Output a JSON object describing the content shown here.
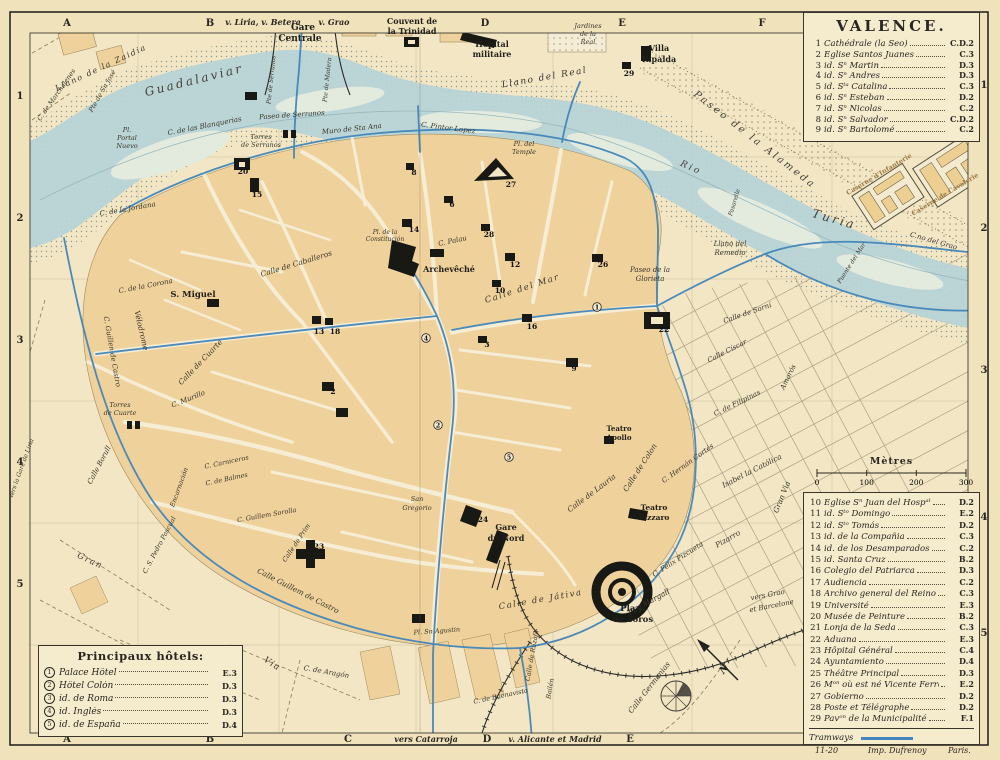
{
  "title": "VALENCE.",
  "colors": {
    "paper": "#f0e2bb",
    "block": "#efd19b",
    "water": "#b7d3d6",
    "tram": "#4286bb",
    "ink": "#2a2722",
    "legend_bg": "#f5ebcd"
  },
  "frame": {
    "top_letters": [
      {
        "t": "A",
        "x": 67
      },
      {
        "t": "B",
        "x": 210
      },
      {
        "t": "D",
        "x": 485
      },
      {
        "t": "E",
        "x": 622
      },
      {
        "t": "F",
        "x": 762
      }
    ],
    "bottom_letters": [
      {
        "t": "A",
        "x": 67
      },
      {
        "t": "B",
        "x": 210
      },
      {
        "t": "C",
        "x": 348
      },
      {
        "t": "D",
        "x": 487
      },
      {
        "t": "E",
        "x": 630
      }
    ],
    "left_numbers": [
      {
        "t": "1",
        "y": 96
      },
      {
        "t": "2",
        "y": 218
      },
      {
        "t": "3",
        "y": 340
      },
      {
        "t": "4",
        "y": 462
      },
      {
        "t": "5",
        "y": 584
      }
    ],
    "right_numbers": [
      {
        "t": "1",
        "y": 85
      },
      {
        "t": "2",
        "y": 228
      },
      {
        "t": "3",
        "y": 370
      },
      {
        "t": "4",
        "y": 517
      },
      {
        "t": "5",
        "y": 633
      }
    ],
    "top_routes": [
      {
        "t": "v. Liria, v. Betera",
        "x": 263
      },
      {
        "t": "v. Grao",
        "x": 334
      }
    ],
    "bottom_routes": [
      {
        "t": "vers Catarroja",
        "x": 426
      },
      {
        "t": "v. Alicante et Madrid",
        "x": 555
      }
    ]
  },
  "legend_churches": {
    "items": [
      {
        "num": "1",
        "name": "Cathédrale (la Seo)",
        "ref": "C.D.2"
      },
      {
        "num": "2",
        "name": "Eglise Santos Juanes",
        "ref": "C.3"
      },
      {
        "num": "3",
        "name": "  id.  Sⁿ Martin",
        "ref": "D.3"
      },
      {
        "num": "4",
        "name": "  id.  Sⁿ Andres",
        "ref": "D.3"
      },
      {
        "num": "5",
        "name": "  id.  Sᵗᵃ Catalina",
        "ref": "C.3"
      },
      {
        "num": "6",
        "name": "  id.  Sⁿ Esteban",
        "ref": "D.2"
      },
      {
        "num": "7",
        "name": "  id.  Sⁿ Nicolas",
        "ref": "C.2"
      },
      {
        "num": "8",
        "name": "  id.  Sⁿ Salvador",
        "ref": "C.D.2"
      },
      {
        "num": "9",
        "name": "  id.  Sⁿ Bartolomé",
        "ref": "C.2"
      }
    ]
  },
  "scale": {
    "title": "Mètres",
    "ticks": [
      "0",
      "100",
      "200",
      "300"
    ]
  },
  "legend_main": {
    "tramways": "Tramways",
    "items": [
      {
        "num": "10",
        "name": "Eglise Sⁿ Juan del Hospᵃˡ",
        "ref": "D.2"
      },
      {
        "num": "11",
        "name": "  id. Sᵗᵒ Domingo",
        "ref": "E.2"
      },
      {
        "num": "12",
        "name": "  id. Sᵗᵒ Tomás",
        "ref": "D.2"
      },
      {
        "num": "13",
        "name": "  id. de la Compañia",
        "ref": "C.3"
      },
      {
        "num": "14",
        "name": "  id. de los Desamparados",
        "ref": "C.2"
      },
      {
        "num": "15",
        "name": "  id. Santa Cruz",
        "ref": "B.2"
      },
      {
        "num": "16",
        "name": "Colegio del Patriarca",
        "ref": "D.3"
      },
      {
        "num": "17",
        "name": "Audiencia",
        "ref": "C.2"
      },
      {
        "num": "18",
        "name": "Archivo general del Reino",
        "ref": "C.3"
      },
      {
        "num": "19",
        "name": "Université",
        "ref": "E.3"
      },
      {
        "num": "20",
        "name": "Musée de Peinture",
        "ref": "B.2"
      },
      {
        "num": "21",
        "name": "Lonja de la Seda",
        "ref": "C.3"
      },
      {
        "num": "22",
        "name": "Aduana",
        "ref": "E.3"
      },
      {
        "num": "23",
        "name": "Hôpital Général",
        "ref": "C.4"
      },
      {
        "num": "24",
        "name": "Ayuntamiento",
        "ref": "D.4"
      },
      {
        "num": "25",
        "name": "Théâtre Principal",
        "ref": "D.3"
      },
      {
        "num": "26",
        "name": "Mᵒⁿ où est né Vicente Ferrer",
        "ref": "E.2"
      },
      {
        "num": "27",
        "name": "Gobierno",
        "ref": "D.2"
      },
      {
        "num": "28",
        "name": "Poste et Télégraphe",
        "ref": "D.2"
      },
      {
        "num": "29",
        "name": "Pavᵒⁿ de la Municipalité",
        "ref": "F.1"
      }
    ]
  },
  "hotels": {
    "title": "Principaux hôtels:",
    "items": [
      {
        "num": "1",
        "name": "Palace Hôtel",
        "ref": "E.3"
      },
      {
        "num": "2",
        "name": "Hôtel Colón",
        "ref": "D.3"
      },
      {
        "num": "3",
        "name": "  id.  de Roma",
        "ref": "D.3"
      },
      {
        "num": "4",
        "name": "  id.  Inglés",
        "ref": "D.3"
      },
      {
        "num": "5",
        "name": "  id.  de España",
        "ref": "D.4"
      }
    ]
  },
  "credits": {
    "plate": "11-20",
    "imprint_left": "Imp. Dufrenoy",
    "imprint_right": "Paris."
  },
  "map": {
    "labels": [
      {
        "t": "Gare",
        "x": 303,
        "y": 30,
        "s": 9,
        "k": "pl"
      },
      {
        "t": "Centrale",
        "x": 300,
        "y": 41,
        "s": 9,
        "k": "pl"
      },
      {
        "t": "Couvent de",
        "x": 412,
        "y": 24,
        "s": 8,
        "k": "pl"
      },
      {
        "t": "la Trinidad",
        "x": 412,
        "y": 34,
        "s": 8,
        "k": "pl"
      },
      {
        "t": "Hôpital",
        "x": 492,
        "y": 47,
        "s": 8,
        "k": "pl"
      },
      {
        "t": "militaire",
        "x": 492,
        "y": 57,
        "s": 8,
        "k": "pl"
      },
      {
        "t": "Villa",
        "x": 659,
        "y": 51,
        "s": 8,
        "k": "pl"
      },
      {
        "t": "Ripalda",
        "x": 659,
        "y": 62,
        "s": 8,
        "k": "pl"
      },
      {
        "t": "Jardines",
        "x": 588,
        "y": 28,
        "s": 6.5
      },
      {
        "t": "de la",
        "x": 588,
        "y": 36,
        "s": 6.5
      },
      {
        "t": "Real",
        "x": 588,
        "y": 44,
        "s": 6.5
      },
      {
        "t": "Llano del Real",
        "x": 545,
        "y": 80,
        "r": -10,
        "s": 9,
        "k": "sp"
      },
      {
        "t": "Llano de la Zaidia",
        "x": 102,
        "y": 70,
        "r": -25,
        "s": 8,
        "k": "sp"
      },
      {
        "t": "Guadalaviar",
        "x": 195,
        "y": 84,
        "r": -14,
        "s": 12,
        "k": "big"
      },
      {
        "t": "C. de Marchalenes",
        "x": 58,
        "y": 96,
        "r": -55,
        "s": 6.5
      },
      {
        "t": "Pte de Sn José",
        "x": 104,
        "y": 92,
        "r": -60,
        "s": 6.5
      },
      {
        "t": "Pte de Serranos",
        "x": 273,
        "y": 80,
        "r": -84,
        "s": 6
      },
      {
        "t": "Pte de Madera",
        "x": 329,
        "y": 80,
        "r": -84,
        "s": 6
      },
      {
        "t": "Pl.",
        "x": 127,
        "y": 132,
        "s": 6.5
      },
      {
        "t": "Portal",
        "x": 127,
        "y": 140,
        "s": 6.5
      },
      {
        "t": "Nuevo",
        "x": 127,
        "y": 148,
        "s": 6.5
      },
      {
        "t": "Paseo de Serranos",
        "x": 292,
        "y": 117,
        "r": -4,
        "s": 7
      },
      {
        "t": "C. de las Blanquerias",
        "x": 205,
        "y": 128,
        "r": -11,
        "s": 7
      },
      {
        "t": "Torres",
        "x": 261,
        "y": 139,
        "s": 6.5
      },
      {
        "t": "de Serranos",
        "x": 261,
        "y": 147,
        "s": 6.5
      },
      {
        "t": "Muro de Sta Ana",
        "x": 352,
        "y": 131,
        "r": -6,
        "s": 7
      },
      {
        "t": "C. Pintor Lopez",
        "x": 448,
        "y": 130,
        "r": 7,
        "s": 7
      },
      {
        "t": "Pl. del",
        "x": 524,
        "y": 146,
        "s": 6.5
      },
      {
        "t": "Temple",
        "x": 524,
        "y": 154,
        "s": 6.5
      },
      {
        "t": "C. de la Jordana",
        "x": 128,
        "y": 211,
        "r": -10,
        "s": 7
      },
      {
        "t": "C. de la Corona",
        "x": 146,
        "y": 288,
        "r": -11,
        "s": 7
      },
      {
        "t": "S. Miguel",
        "x": 193,
        "y": 297,
        "s": 8.5,
        "k": "pl"
      },
      {
        "t": "Vélodrome",
        "x": 139,
        "y": 331,
        "r": 77,
        "s": 7.5
      },
      {
        "t": "C. Guillen de Castro",
        "x": 110,
        "y": 352,
        "r": 80,
        "s": 7
      },
      {
        "t": "Calle de Caballeros",
        "x": 297,
        "y": 266,
        "r": -17,
        "s": 7.5
      },
      {
        "t": "Calle de Cuarte",
        "x": 202,
        "y": 364,
        "r": -46,
        "s": 7.5
      },
      {
        "t": "C. Murillo",
        "x": 189,
        "y": 401,
        "r": -22,
        "s": 7
      },
      {
        "t": "Torres",
        "x": 120,
        "y": 407,
        "s": 6.5
      },
      {
        "t": "de Cuarte",
        "x": 120,
        "y": 415,
        "s": 6.5
      },
      {
        "t": "Pl. de la",
        "x": 385,
        "y": 234,
        "s": 6
      },
      {
        "t": "Constitución",
        "x": 385,
        "y": 241,
        "s": 6
      },
      {
        "t": "C. Palau",
        "x": 453,
        "y": 243,
        "r": -12,
        "s": 7
      },
      {
        "t": "Archevêché",
        "x": 449,
        "y": 272,
        "s": 8,
        "k": "pl"
      },
      {
        "t": "Calle del Mar",
        "x": 523,
        "y": 291,
        "r": -18,
        "s": 8.5,
        "k": "sp"
      },
      {
        "t": "Paseo de la",
        "x": 650,
        "y": 272,
        "s": 7
      },
      {
        "t": "Glorieta",
        "x": 650,
        "y": 281,
        "s": 7
      },
      {
        "t": "Llano del",
        "x": 730,
        "y": 246,
        "s": 7
      },
      {
        "t": "Remedio",
        "x": 730,
        "y": 255,
        "s": 7
      },
      {
        "t": "Rio",
        "x": 690,
        "y": 170,
        "r": 24,
        "s": 9,
        "k": "big"
      },
      {
        "t": "Turia",
        "x": 833,
        "y": 223,
        "r": 16,
        "s": 12,
        "k": "big"
      },
      {
        "t": "Paseo de la Alameda",
        "x": 753,
        "y": 142,
        "r": 38,
        "s": 10,
        "k": "big"
      },
      {
        "t": "Caserne d'Infanterie",
        "x": 880,
        "y": 176,
        "r": -31,
        "s": 6.5,
        "k": "cas"
      },
      {
        "t": "Caserne de Cavalerie",
        "x": 946,
        "y": 196,
        "r": -31,
        "s": 6.5,
        "k": "cas"
      },
      {
        "t": "Pasarelle",
        "x": 736,
        "y": 203,
        "r": -73,
        "s": 6
      },
      {
        "t": "Puente del Mar",
        "x": 853,
        "y": 264,
        "r": -57,
        "s": 6
      },
      {
        "t": "C.no del Grao",
        "x": 933,
        "y": 243,
        "r": 16,
        "s": 7
      },
      {
        "t": "vers Grao",
        "x": 768,
        "y": 597,
        "r": -11,
        "s": 7
      },
      {
        "t": "et Barcelone",
        "x": 772,
        "y": 608,
        "r": -11,
        "s": 7
      },
      {
        "t": "Calle Germanias",
        "x": 651,
        "y": 689,
        "r": -52,
        "s": 7.5
      },
      {
        "t": "Pi y Margall",
        "x": 650,
        "y": 604,
        "r": -29,
        "s": 7.5
      },
      {
        "t": "C. Félix Pizcueta",
        "x": 679,
        "y": 561,
        "r": -33,
        "s": 7
      },
      {
        "t": "Pizarro",
        "x": 729,
        "y": 541,
        "r": -30,
        "s": 7.5
      },
      {
        "t": "Gran Via",
        "x": 784,
        "y": 498,
        "r": -68,
        "s": 7.5
      },
      {
        "t": "Isabel la Católica",
        "x": 753,
        "y": 473,
        "r": -27,
        "s": 7.5
      },
      {
        "t": "C. Hernán Cortés",
        "x": 689,
        "y": 465,
        "r": -36,
        "s": 7
      },
      {
        "t": "Calle de Colon",
        "x": 642,
        "y": 469,
        "r": -57,
        "s": 7.5
      },
      {
        "t": "Calle de Lauria",
        "x": 593,
        "y": 495,
        "r": -37,
        "s": 7.5
      },
      {
        "t": "Teatro",
        "x": 619,
        "y": 431,
        "s": 7,
        "k": "pl"
      },
      {
        "t": "Apollo",
        "x": 619,
        "y": 440,
        "s": 7,
        "k": "pl"
      },
      {
        "t": "Teatro",
        "x": 654,
        "y": 510,
        "s": 7.5,
        "k": "pl"
      },
      {
        "t": "Pizzaro",
        "x": 654,
        "y": 520,
        "s": 7.5,
        "k": "pl"
      },
      {
        "t": "Calle de Sorní",
        "x": 748,
        "y": 315,
        "r": -19,
        "s": 7
      },
      {
        "t": "Calle Císcar",
        "x": 728,
        "y": 353,
        "r": -27,
        "s": 7
      },
      {
        "t": "C. de Filipinas",
        "x": 738,
        "y": 405,
        "r": -26,
        "s": 7
      },
      {
        "t": "Amorós",
        "x": 790,
        "y": 378,
        "r": -64,
        "s": 7
      },
      {
        "t": "San",
        "x": 417,
        "y": 501,
        "s": 6.5
      },
      {
        "t": "Gregorio",
        "x": 417,
        "y": 510,
        "s": 6.5
      },
      {
        "t": "Gare",
        "x": 506,
        "y": 530,
        "s": 8,
        "k": "pl"
      },
      {
        "t": "du Nord",
        "x": 506,
        "y": 541,
        "s": 8,
        "k": "pl"
      },
      {
        "t": "Calle de Játiva",
        "x": 541,
        "y": 602,
        "r": -10,
        "s": 8.5,
        "k": "sp"
      },
      {
        "t": "Pl. Sn Agustin",
        "x": 437,
        "y": 633,
        "r": -4,
        "s": 6.5
      },
      {
        "t": "Plaza",
        "x": 633,
        "y": 611,
        "s": 8.5,
        "k": "pl"
      },
      {
        "t": "de Toros",
        "x": 633,
        "y": 622,
        "s": 8.5,
        "k": "pl"
      },
      {
        "t": "Gran",
        "x": 89,
        "y": 563,
        "r": 25,
        "s": 8.5,
        "k": "sp"
      },
      {
        "t": "Via",
        "x": 271,
        "y": 666,
        "r": 33,
        "s": 8.5,
        "k": "sp"
      },
      {
        "t": "C. de Aragón",
        "x": 326,
        "y": 674,
        "r": 10,
        "s": 7
      },
      {
        "t": "Calle Borull",
        "x": 101,
        "y": 466,
        "r": -62,
        "s": 7
      },
      {
        "t": "C. Carniceros",
        "x": 227,
        "y": 464,
        "r": -12,
        "s": 6.5
      },
      {
        "t": "C. de Balmes",
        "x": 227,
        "y": 481,
        "r": -12,
        "s": 6.5
      },
      {
        "t": "Encarnación",
        "x": 181,
        "y": 488,
        "r": -70,
        "s": 6.5
      },
      {
        "t": "C. S. Pedro Pascual",
        "x": 161,
        "y": 546,
        "r": -62,
        "s": 6.5
      },
      {
        "t": "C. Guillem Sorolla",
        "x": 267,
        "y": 517,
        "r": -10,
        "s": 6.5
      },
      {
        "t": "Calle de Prim",
        "x": 298,
        "y": 544,
        "r": -56,
        "s": 6.5
      },
      {
        "t": "Calle Guillem de Castro",
        "x": 297,
        "y": 593,
        "r": 27,
        "s": 7.5
      },
      {
        "t": "vers la Gare de Liria",
        "x": 23,
        "y": 469,
        "r": -70,
        "s": 6
      },
      {
        "t": "C. de Buenavista",
        "x": 501,
        "y": 698,
        "r": -12,
        "s": 6.5
      },
      {
        "t": "Bailén",
        "x": 552,
        "y": 689,
        "r": -80,
        "s": 6.5
      },
      {
        "t": "Calle de Ruzafa",
        "x": 534,
        "y": 656,
        "r": -80,
        "s": 6.5
      }
    ],
    "markers": [
      {
        "t": "20",
        "x": 243,
        "y": 171
      },
      {
        "t": "15",
        "x": 257,
        "y": 194
      },
      {
        "t": "8",
        "x": 414,
        "y": 172
      },
      {
        "t": "6",
        "x": 452,
        "y": 204
      },
      {
        "t": "27",
        "x": 511,
        "y": 184
      },
      {
        "t": "29",
        "x": 629,
        "y": 73
      },
      {
        "t": "14",
        "x": 414,
        "y": 229
      },
      {
        "t": "28",
        "x": 489,
        "y": 234
      },
      {
        "t": "12",
        "x": 515,
        "y": 264
      },
      {
        "t": "26",
        "x": 603,
        "y": 264
      },
      {
        "t": "10",
        "x": 500,
        "y": 290
      },
      {
        "t": "16",
        "x": 532,
        "y": 326
      },
      {
        "t": "13",
        "x": 319,
        "y": 331
      },
      {
        "t": "18",
        "x": 335,
        "y": 331
      },
      {
        "t": "2",
        "x": 333,
        "y": 391
      },
      {
        "t": "3",
        "x": 487,
        "y": 344
      },
      {
        "t": "9",
        "x": 574,
        "y": 368
      },
      {
        "t": "22",
        "x": 664,
        "y": 329
      },
      {
        "t": "24",
        "x": 483,
        "y": 519
      },
      {
        "t": "23",
        "x": 319,
        "y": 546
      },
      {
        "t": "1",
        "x": 597,
        "y": 307,
        "c": 1
      },
      {
        "t": "2",
        "x": 438,
        "y": 425,
        "c": 1
      },
      {
        "t": "5",
        "x": 509,
        "y": 457,
        "c": 1
      },
      {
        "t": "4",
        "x": 426,
        "y": 338,
        "c": 1
      }
    ]
  }
}
